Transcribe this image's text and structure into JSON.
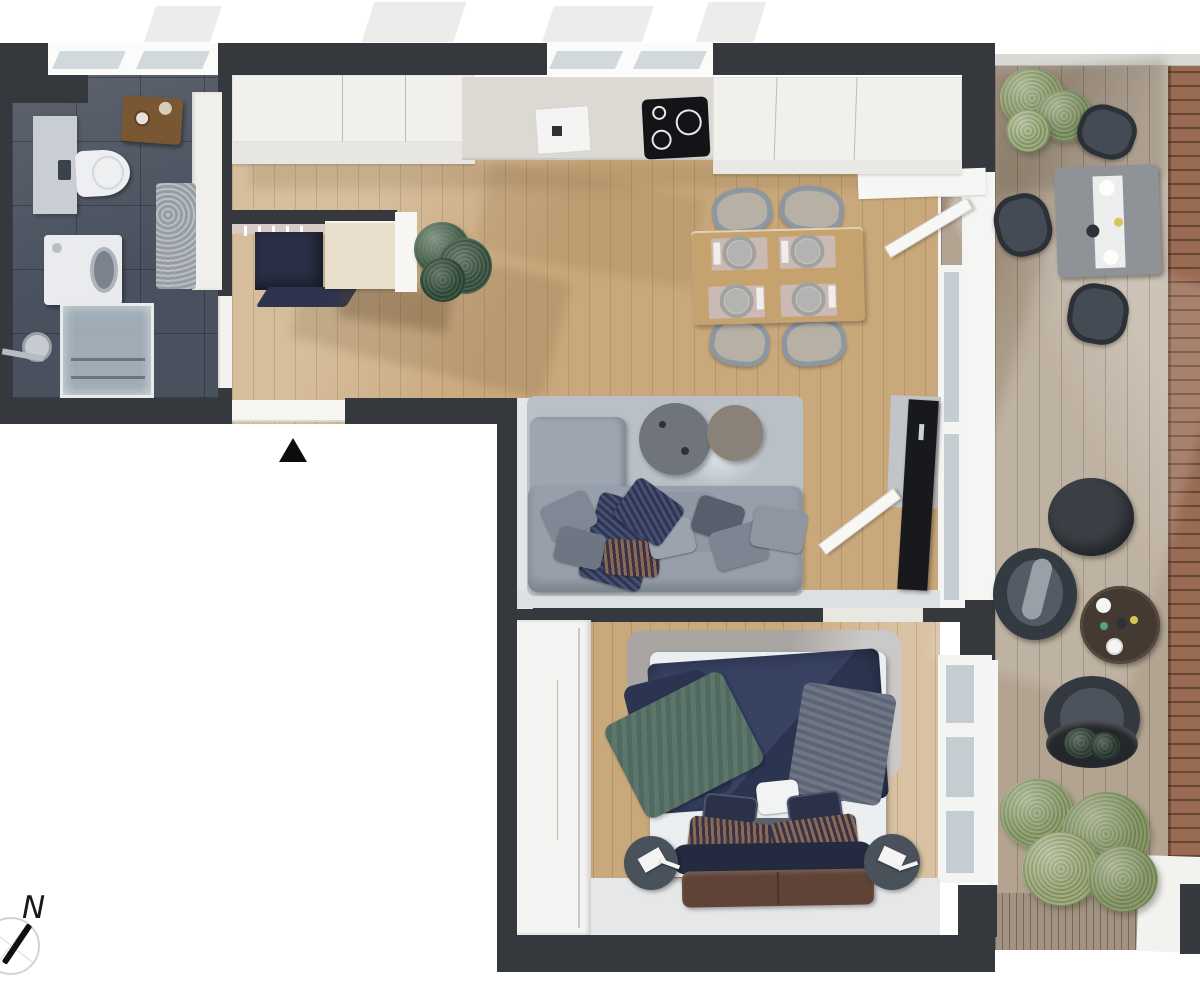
{
  "meta": {
    "kind": "apartment-floor-plan-3d-top-view",
    "visible_text": [
      "N"
    ]
  },
  "compass": {
    "label": "N",
    "needle_direction": "north-northeast"
  },
  "palette": {
    "wall": "#35383d",
    "wood": "#c9a87c",
    "bathtile": "#4a515e",
    "deckwood": "#b3a492",
    "deckslat": "#a29282",
    "brick": "#996b53",
    "glass": "#c4ced2",
    "rugliv": "#b9c1c7",
    "rugbed": "#a9a5a2",
    "bush": "#93a372",
    "navy": "#2e3550",
    "sofa": "#97a0aa",
    "bench": "#5e4336",
    "sideboard": "#e7dfcb",
    "counter": "#dcd9d3"
  },
  "rooms": [
    {
      "name": "bathroom",
      "furniture": [
        "toilet",
        "washing-machine",
        "shower",
        "shower-mixer",
        "bath-mat",
        "vanity",
        "wall-shelf"
      ]
    },
    {
      "name": "hallway",
      "furniture": [
        "coat-closet",
        "sideboard",
        "doormat",
        "entrance-door",
        "entrance-marker"
      ]
    },
    {
      "name": "kitchen",
      "furniture": [
        "upper-cabinets",
        "countertop",
        "sink",
        "cooktop",
        "potted-plant"
      ]
    },
    {
      "name": "dining-area",
      "furniture": [
        "dining-table",
        "dining-chair",
        "dining-chair",
        "dining-chair",
        "dining-chair",
        "place-setting",
        "place-setting",
        "place-setting",
        "place-setting"
      ]
    },
    {
      "name": "living-room",
      "furniture": [
        "corner-sofa",
        "sofa-pillows",
        "coffee-table-large",
        "coffee-table-small",
        "area-rug",
        "tv",
        "tv-panel",
        "bedroom-door",
        "terrace-door"
      ]
    },
    {
      "name": "bedroom",
      "furniture": [
        "double-bed",
        "duvet",
        "green-throw",
        "pillows",
        "foot-bench",
        "nightstand-left",
        "nightstand-right",
        "table-lamp",
        "table-lamp",
        "wardrobe",
        "area-rug"
      ]
    },
    {
      "name": "terrace",
      "furniture": [
        "outdoor-dining-table",
        "wicker-chair",
        "wicker-chair",
        "wicker-chair",
        "lounge-chair",
        "lounge-chair",
        "pouf",
        "round-side-table",
        "planter-bowl",
        "shrub",
        "shrub"
      ]
    }
  ]
}
